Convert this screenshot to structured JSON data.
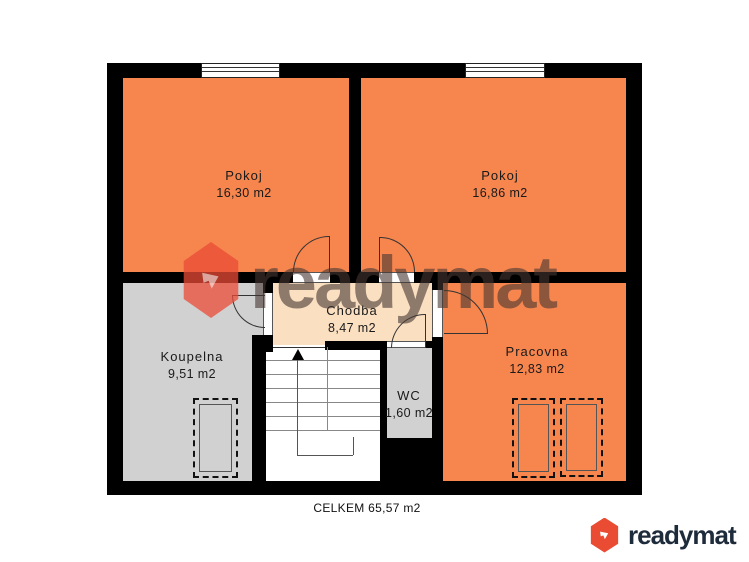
{
  "plan": {
    "rooms": [
      {
        "name": "Pokoj",
        "area": "16,30 m2"
      },
      {
        "name": "Pokoj",
        "area": "16,86 m2"
      },
      {
        "name": "Chodba",
        "area": "8,47 m2"
      },
      {
        "name": "Koupelna",
        "area": "9,51 m2"
      },
      {
        "name": "WC",
        "area": "1,60 m2"
      },
      {
        "name": "Pracovna",
        "area": "12,83 m2"
      }
    ],
    "total_label": "CELKEM 65,57 m2"
  },
  "branding": {
    "watermark_text": "readymat",
    "logo_text": "readymat"
  },
  "colors": {
    "room_orange": "#F6854E",
    "room_gray": "#D1D1D1",
    "hallway_cream": "#FBDFC1",
    "wall_black": "#000000",
    "brand_red": "#E94B33",
    "logo_navy": "#1E2B3B"
  }
}
